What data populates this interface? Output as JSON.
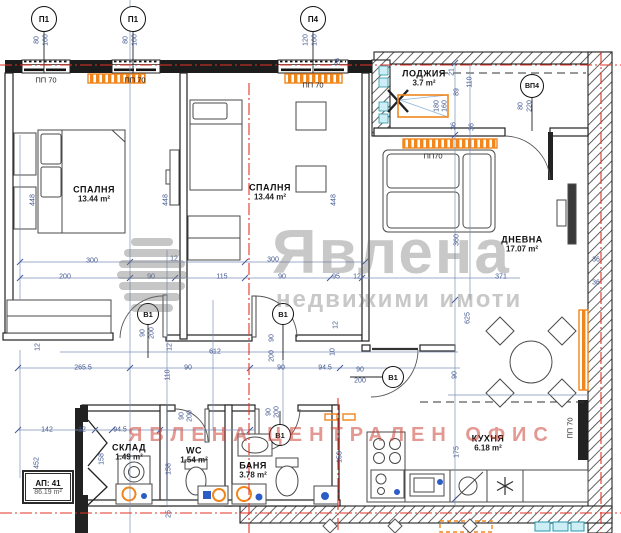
{
  "watermark": {
    "logo": "Явлена",
    "tagline": "недвижими имоти",
    "stamp": "ЯВЛЕНА ЦЕНТРАЛЕН ОФИС",
    "gray": "rgba(110,110,110,0.38)",
    "red": "rgba(206,68,56,0.55)"
  },
  "apartment": {
    "label": "АП: 41",
    "area": "86.19 m²"
  },
  "colors": {
    "walls": "#1c1c1c",
    "dims": "#3f568f",
    "axis_red": "#e63227",
    "radiator_orange": "#f0861c",
    "fixture_cyan": "#2596ab"
  },
  "room_labels": [
    {
      "name": "СПАЛНЯ",
      "area": "13.44 m²",
      "x": 94,
      "y": 194
    },
    {
      "name": "СПАЛНЯ",
      "area": "13.44 m²",
      "x": 270,
      "y": 192
    },
    {
      "name": "ЛОДЖИЯ",
      "area": "3.7 m²",
      "x": 424,
      "y": 78
    },
    {
      "name": "ДНЕВНА",
      "area": "17.07 m²",
      "x": 522,
      "y": 244
    },
    {
      "name": "КУХНЯ",
      "area": "6.18 m²",
      "x": 488,
      "y": 443
    },
    {
      "name": "СКЛАД",
      "area": "1.49 m²",
      "x": 129,
      "y": 452
    },
    {
      "name": "WC",
      "area": "1.54 m²",
      "x": 194,
      "y": 455
    },
    {
      "name": "БАНЯ",
      "area": "3.78 m²",
      "x": 253,
      "y": 470
    }
  ],
  "markers": [
    {
      "label": "П1",
      "x": 44,
      "y": 19
    },
    {
      "label": "П1",
      "x": 133,
      "y": 19
    },
    {
      "label": "П4",
      "x": 313,
      "y": 19
    },
    {
      "label": "ВП4",
      "x": 532,
      "y": 86,
      "cls": "md"
    },
    {
      "label": "В1",
      "x": 148,
      "y": 314,
      "cls": "sm"
    },
    {
      "label": "В1",
      "x": 283,
      "y": 314,
      "cls": "sm"
    },
    {
      "label": "В1",
      "x": 393,
      "y": 377,
      "cls": "sm"
    },
    {
      "label": "В1",
      "x": 280,
      "y": 435,
      "cls": "sm"
    }
  ],
  "wall_labels": [
    {
      "t": "ПП 70",
      "x": 46,
      "y": 80
    },
    {
      "t": "ПП 70",
      "x": 135,
      "y": 80
    },
    {
      "t": "ПП 70",
      "x": 313,
      "y": 85
    },
    {
      "t": "ПП70",
      "x": 433,
      "y": 156
    },
    {
      "t": "ПП 70",
      "x": 570,
      "y": 428,
      "r": 1
    }
  ],
  "dims": [
    {
      "t": "80",
      "x": 37,
      "y": 40,
      "r": 1
    },
    {
      "t": "160",
      "x": 46,
      "y": 40,
      "r": 1
    },
    {
      "t": "80",
      "x": 126,
      "y": 40,
      "r": 1
    },
    {
      "t": "160",
      "x": 135,
      "y": 40,
      "r": 1
    },
    {
      "t": "120",
      "x": 306,
      "y": 40,
      "r": 1
    },
    {
      "t": "160",
      "x": 315,
      "y": 40,
      "r": 1
    },
    {
      "t": "80",
      "x": 521,
      "y": 106,
      "r": 1
    },
    {
      "t": "220",
      "x": 530,
      "y": 106,
      "r": 1
    },
    {
      "t": "21",
      "x": 452,
      "y": 72,
      "r": 1
    },
    {
      "t": "89",
      "x": 457,
      "y": 92,
      "r": 1
    },
    {
      "t": "110",
      "x": 470,
      "y": 82,
      "r": 1
    },
    {
      "t": "26",
      "x": 338,
      "y": 62,
      "r": 1
    },
    {
      "t": "36",
      "x": 454,
      "y": 126,
      "r": 1
    },
    {
      "t": "36",
      "x": 472,
      "y": 127,
      "r": 1
    },
    {
      "t": "180",
      "x": 437,
      "y": 106,
      "r": 1
    },
    {
      "t": "160",
      "x": 445,
      "y": 106,
      "r": 1
    },
    {
      "t": "448",
      "x": 33,
      "y": 200,
      "r": 1
    },
    {
      "t": "448",
      "x": 166,
      "y": 200,
      "r": 1
    },
    {
      "t": "448",
      "x": 334,
      "y": 200,
      "r": 1
    },
    {
      "t": "300",
      "x": 92,
      "y": 261
    },
    {
      "t": "12",
      "x": 174,
      "y": 259
    },
    {
      "t": "300",
      "x": 273,
      "y": 260
    },
    {
      "t": "200",
      "x": 65,
      "y": 277
    },
    {
      "t": "90",
      "x": 151,
      "y": 277
    },
    {
      "t": "115",
      "x": 222,
      "y": 277
    },
    {
      "t": "90",
      "x": 282,
      "y": 277
    },
    {
      "t": "95",
      "x": 336,
      "y": 277
    },
    {
      "t": "12",
      "x": 357,
      "y": 277
    },
    {
      "t": "371",
      "x": 501,
      "y": 277
    },
    {
      "t": "360",
      "x": 457,
      "y": 240,
      "r": 1
    },
    {
      "t": "625",
      "x": 468,
      "y": 318,
      "r": 1
    },
    {
      "t": "90",
      "x": 455,
      "y": 375,
      "r": 1
    },
    {
      "t": "36",
      "x": 596,
      "y": 260
    },
    {
      "t": "36",
      "x": 596,
      "y": 283
    },
    {
      "t": "90",
      "x": 143,
      "y": 333,
      "r": 1
    },
    {
      "t": "200",
      "x": 152,
      "y": 333,
      "r": 1
    },
    {
      "t": "90",
      "x": 272,
      "y": 338,
      "r": 1
    },
    {
      "t": "200",
      "x": 272,
      "y": 356,
      "r": 1
    },
    {
      "t": "12",
      "x": 336,
      "y": 325,
      "r": 1
    },
    {
      "t": "10",
      "x": 333,
      "y": 352,
      "r": 1
    },
    {
      "t": "612",
      "x": 215,
      "y": 352
    },
    {
      "t": "265.5",
      "x": 83,
      "y": 368
    },
    {
      "t": "90",
      "x": 188,
      "y": 368
    },
    {
      "t": "110",
      "x": 168,
      "y": 375,
      "r": 1
    },
    {
      "t": "90",
      "x": 281,
      "y": 368
    },
    {
      "t": "94.5",
      "x": 325,
      "y": 368
    },
    {
      "t": "90",
      "x": 360,
      "y": 370
    },
    {
      "t": "200",
      "x": 360,
      "y": 381
    },
    {
      "t": "90",
      "x": 269,
      "y": 412,
      "r": 1
    },
    {
      "t": "200",
      "x": 277,
      "y": 412,
      "r": 1
    },
    {
      "t": "90",
      "x": 182,
      "y": 416,
      "r": 1
    },
    {
      "t": "200",
      "x": 190,
      "y": 416,
      "r": 1
    },
    {
      "t": "142",
      "x": 47,
      "y": 430
    },
    {
      "t": "12",
      "x": 82,
      "y": 430
    },
    {
      "t": "94.5",
      "x": 120,
      "y": 430
    },
    {
      "t": "452",
      "x": 37,
      "y": 463,
      "r": 1
    },
    {
      "t": "158",
      "x": 102,
      "y": 459,
      "r": 1
    },
    {
      "t": "158",
      "x": 169,
      "y": 469,
      "r": 1
    },
    {
      "t": "153",
      "x": 340,
      "y": 457,
      "r": 1
    },
    {
      "t": "175",
      "x": 457,
      "y": 452,
      "r": 1
    },
    {
      "t": "25",
      "x": 169,
      "y": 514,
      "r": 1
    },
    {
      "t": "12",
      "x": 38,
      "y": 347,
      "r": 1
    },
    {
      "t": "12",
      "x": 170,
      "y": 347,
      "r": 1
    }
  ]
}
